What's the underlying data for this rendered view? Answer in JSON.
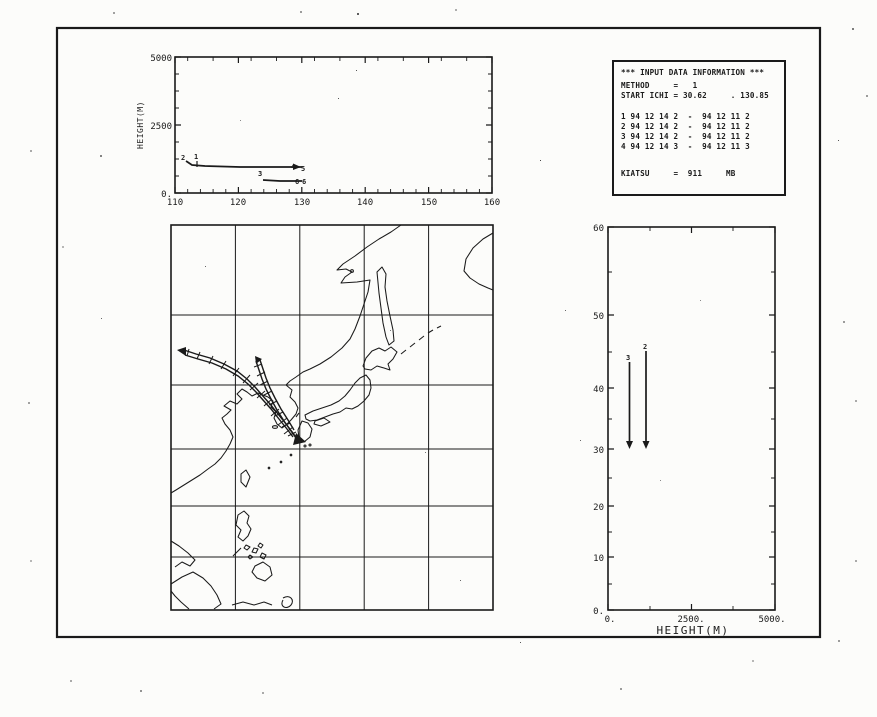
{
  "top_chart": {
    "ylabel": "HEIGHT(M)",
    "yticks": [
      "5000",
      "2500",
      "0."
    ],
    "xticks": [
      "110",
      "120",
      "130",
      "140",
      "150",
      "160"
    ],
    "labels": {
      "upper_start": "2",
      "upper_tick": "1",
      "upper_end_a": "4",
      "upper_end_b": "5",
      "lower_start": "3",
      "lower_end_a": "6",
      "lower_end_b": "6"
    }
  },
  "right_chart": {
    "xlabel": "HEIGHT(M)",
    "xticks": [
      "0.",
      "2500.",
      "5000."
    ],
    "yticks": [
      "60",
      "50",
      "40",
      "30",
      "20",
      "10",
      "0."
    ],
    "labels": {
      "line_a_top": "3",
      "line_b_top": "2"
    }
  },
  "info_box": {
    "title": "*** INPUT DATA INFORMATION ***",
    "method_line": "METHOD     =   1",
    "start_line": "START ICHI = 30.62     . 130.85",
    "data_lines": [
      "1 94 12 14 2  -  94 12 11 2",
      "2 94 12 14 2  -  94 12 11 2",
      "3 94 12 14 2  -  94 12 11 2",
      "4 94 12 14 3  -  94 12 11 3"
    ],
    "kiatsu_line": "KIATSU     =  911     MB"
  },
  "colors": {
    "ink": "#1a1a1a",
    "paper": "#fcfcfa"
  },
  "chart_data": [
    {
      "type": "line",
      "title": "Trajectory height vs longitude (top-left panel)",
      "xlabel": "longitude (deg E, unlabeled)",
      "ylabel": "HEIGHT(M)",
      "xlim": [
        110,
        160
      ],
      "ylim": [
        0,
        5000
      ],
      "grid": false,
      "series": [
        {
          "name": "trajectory 2 (markers 2,1 start; 4,5 end)",
          "x": [
            111.7,
            113,
            115,
            120,
            125,
            130
          ],
          "y": [
            1180,
            1020,
            1000,
            990,
            980,
            960
          ]
        },
        {
          "name": "trajectory 3 (marker 3 start; 6,6 end)",
          "x": [
            123.9,
            126,
            128,
            130
          ],
          "y": [
            480,
            460,
            455,
            450
          ]
        }
      ]
    },
    {
      "type": "line",
      "subtype": "map",
      "title": "East Asia map (Mercator) with hatched backward-trajectory bands ending in arrow near 30.6N 130.8E",
      "xlabel": "longitude 110-160E, grid every 10 deg",
      "ylabel": "latitude 0-60N, grid every 10 deg",
      "grid": true,
      "series": [
        {
          "name": "trajectory band 2 (hatched tube with arrow)",
          "x": [
            112.0,
            114.0,
            116.2,
            118.4,
            120.4,
            121.9,
            123.2,
            124.3,
            125.5,
            126.8,
            128.0,
            129.1,
            130.5
          ],
          "y": [
            45.0,
            44.3,
            43.3,
            42.2,
            40.9,
            39.7,
            38.4,
            37.1,
            35.6,
            33.9,
            32.4,
            31.5,
            30.7
          ]
        },
        {
          "name": "trajectory band 3 (hatched tube)",
          "x": [
            123.2,
            123.7,
            124.1,
            124.8,
            125.5,
            126.5,
            127.6,
            128.7,
            130.3
          ],
          "y": [
            43.4,
            42.1,
            40.8,
            39.3,
            37.8,
            36.1,
            34.3,
            32.7,
            30.8
          ]
        }
      ]
    },
    {
      "type": "line",
      "title": "Latitude vs height (right panel)",
      "xlabel": "HEIGHT(M)",
      "ylabel": "latitude (deg N, Mercator-spaced ticks)",
      "xlim": [
        0,
        5000
      ],
      "ylim": [
        0,
        60
      ],
      "grid": false,
      "series": [
        {
          "name": "trajectory 3",
          "x": [
            620,
            620
          ],
          "y": [
            43.4,
            30.7
          ]
        },
        {
          "name": "trajectory 2",
          "x": [
            1130,
            1130
          ],
          "y": [
            45.0,
            30.7
          ]
        }
      ]
    }
  ]
}
